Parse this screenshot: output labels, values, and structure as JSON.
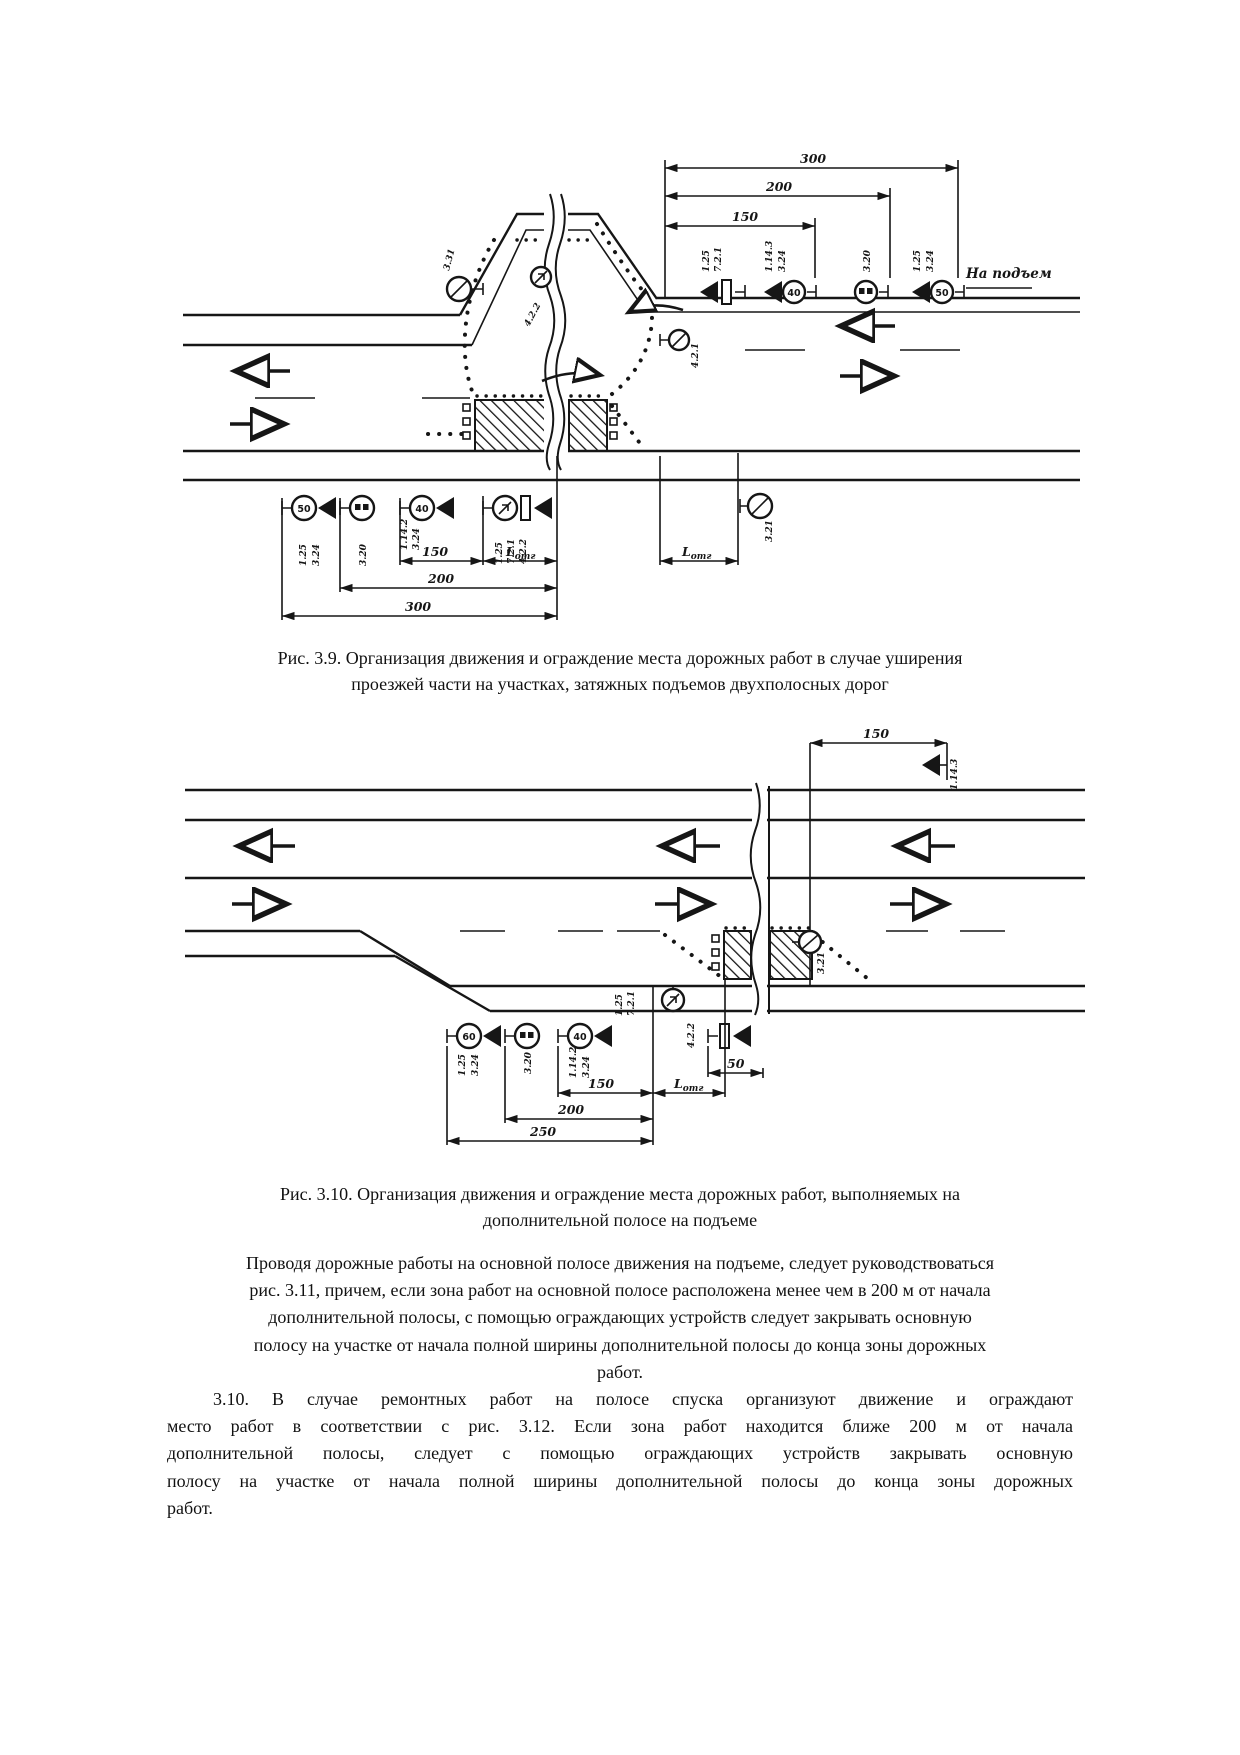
{
  "page": {
    "background": "#ffffff",
    "ink": "#161616"
  },
  "fig39": {
    "caption_lines": [
      "Рис. 3.9. Организация движения и ограждение места дорожных работ в случае уширения",
      "проезжей части на участках, затяжных подъемов двухполосных дорог"
    ],
    "dims": {
      "t300": "300",
      "t200": "200",
      "t150": "150",
      "b150": "150",
      "b200": "200",
      "b300": "300"
    },
    "lotg": {
      "base": "L",
      "sub": "отг"
    },
    "note": "На подъем",
    "signs": {
      "s331": "3.31",
      "s422": "4.2.2",
      "s421": "4.2.1",
      "s321": "3.21",
      "top_g1": [
        "1.25",
        "7.2.1"
      ],
      "top_g2": [
        "1.14.3",
        "3.24"
      ],
      "top_g3": "3.20",
      "top_g4": [
        "1.25",
        "3.24"
      ],
      "bot_g1": [
        "1.25",
        "3.24"
      ],
      "bot_g2": "3.20",
      "bot_g3": [
        "1.14.2",
        "3.24"
      ],
      "bot_g4": [
        "1.25",
        "7.2.1",
        "4.2.2"
      ],
      "speed_50": "50",
      "speed_40": "40"
    }
  },
  "fig310": {
    "caption_lines": [
      "Рис. 3.10. Организация движения и ограждение места дорожных работ, выполняемых на",
      "дополнительной полосе на подъеме"
    ],
    "dims": {
      "t150": "150",
      "b50": "50",
      "b150": "150",
      "b200": "200",
      "b250": "250"
    },
    "lotg": {
      "base": "L",
      "sub": "отг"
    },
    "signs": {
      "s1143": "1.14.3",
      "s321": "3.21",
      "s422": "4.2.2",
      "g1": [
        "1.25",
        "3.24"
      ],
      "g2": "3.20",
      "g3": [
        "1.14.2",
        "3.24"
      ],
      "zone": [
        "1.25",
        "7.2.1"
      ],
      "speed_60": "60",
      "speed_40": "40"
    }
  },
  "paragraphs": {
    "p1_lines": [
      "Проводя дорожные работы на основной полосе движения на подъеме, следует руководствоваться",
      "рис. 3.11, причем, если зона работ на основной полосе расположена менее чем в 200 м от начала",
      "дополнительной полосы, с помощью ограждающих устройств следует закрывать основную",
      "полосу на участке от начала полной ширины дополнительной полосы до конца зоны дорожных",
      "работ."
    ],
    "p2_lines": [
      "3.10. В случае ремонтных работ на полосе спуска организуют движение и ограждают",
      "место работ в соответствии с рис. 3.12. Если зона работ находится ближе 200 м от начала",
      "дополнительной полосы, следует с помощью ограждающих устройств закрывать основную",
      "полосу на участке от начала полной ширины дополнительной полосы до конца зоны дорожных",
      "работ."
    ]
  }
}
